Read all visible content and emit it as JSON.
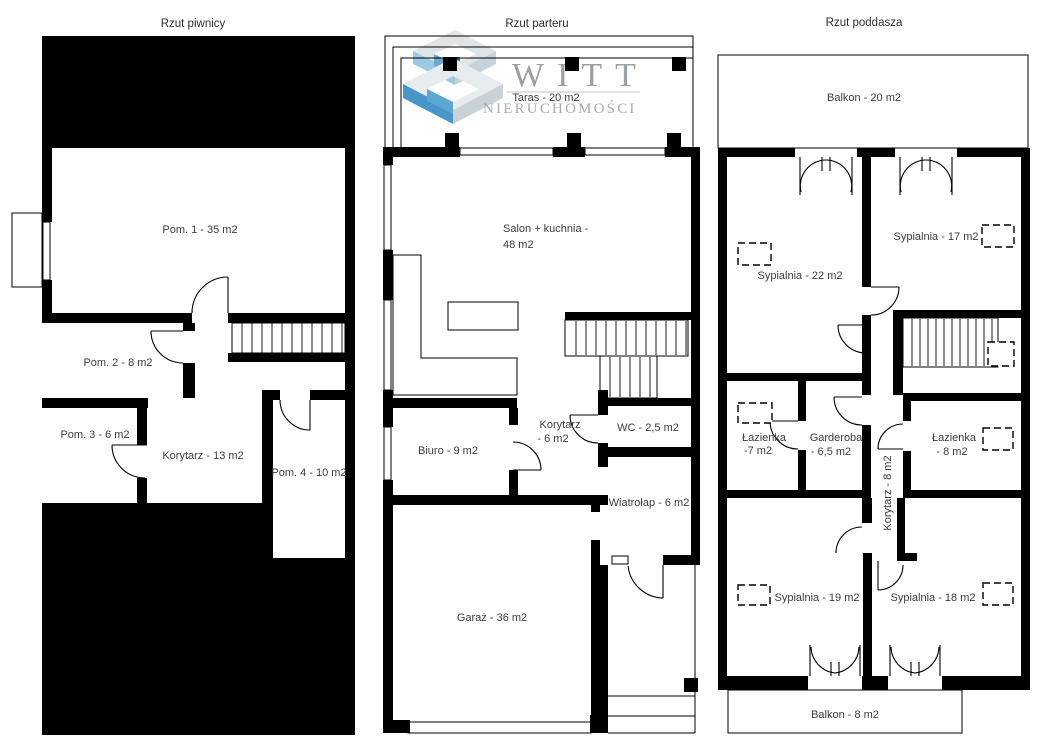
{
  "titles": {
    "basement": "Rzut piwnicy",
    "ground": "Rzut parteru",
    "attic": "Rzut poddasza"
  },
  "basement": {
    "pom1": "Pom. 1 - 35 m2",
    "pom2": "Pom. 2 - 8 m2",
    "pom3": "Pom. 3 - 6 m2",
    "korytarz": "Korytarz - 13 m2",
    "pom4": "Pom. 4 - 10 m2"
  },
  "ground": {
    "taras": "Taras - 20 m2",
    "salon_line1": "Salon + kuchnia -",
    "salon_line2": "48 m2",
    "biuro": "Biuro - 9 m2",
    "korytarz_line1": "Korytarz",
    "korytarz_line2": "- 6 m2",
    "wc": "WC - 2,5 m2",
    "wiatrolap": "Wiatrołap - 6 m2",
    "garaz": "Garaż - 36 m2"
  },
  "attic": {
    "balkon_top": "Balkon - 20 m2",
    "sypialnia22": "Sypialnia - 22 m2",
    "sypialnia17": "Sypialnia - 17 m2",
    "lazienka7_line1": "Łazienka",
    "lazienka7_line2": "-7 m2",
    "garderoba_line1": "Garderoba",
    "garderoba_line2": "- 6,5 m2",
    "korytarz": "Korytarz - 8 m2",
    "lazienka8_line1": "Łazienka",
    "lazienka8_line2": "- 8 m2",
    "sypialnia19": "Sypialnia - 19 m2",
    "sypialnia18": "Sypialnia - 18 m2",
    "balkon_bottom": "Balkon - 8 m2"
  },
  "logo": {
    "brand": "WITT",
    "subtitle": "NIERUCHOMOŚCI",
    "colors": {
      "blue_main": "#4696c9",
      "blue_light": "#9ec9e3",
      "blue_inner": "#5ea6d2",
      "teal_dark": "#2d7597",
      "face_light": "#e8ecee",
      "face_gray": "#c9d2d7",
      "text_gray": "#9aa0a3"
    }
  }
}
